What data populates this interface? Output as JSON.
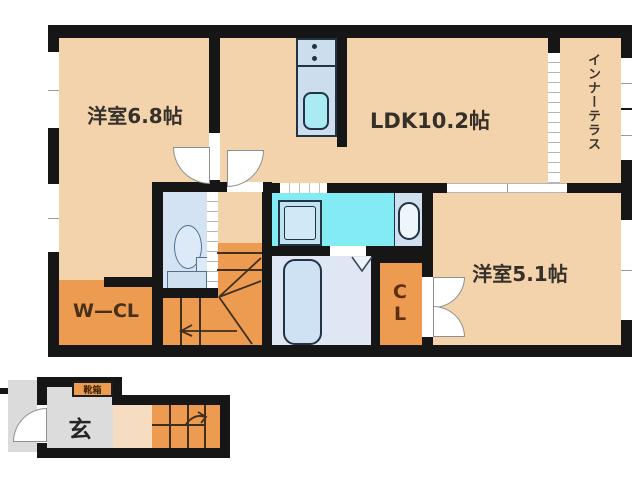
{
  "rooms": {
    "western_room_68": "洋室6.8帖",
    "ldk": "LDK10.2帖",
    "western_room_51": "洋室5.1帖",
    "inner_terrace": "インナーテラス",
    "walk_in_closet": "W—CL",
    "closet": "CL",
    "entrance": "玄",
    "shoe_cabinet": "靴箱"
  },
  "colors": {
    "wall": "#161616",
    "floor_main_peach": "#f3d3ac",
    "floor_orange": "#ec9b51",
    "washroom_cyan": "#82ebf3",
    "wet_area_blue": "#d3e3f3",
    "bathroom_blue": "#dfe7f4",
    "kitchen_counter_blue": "#ccddee",
    "sink_cyan": "#aaebf3",
    "entrance_gray": "#dcdcdc",
    "porch_gray": "#dbdbdb",
    "label_dark": "#35302a",
    "label_brown": "#5c2e0c"
  }
}
